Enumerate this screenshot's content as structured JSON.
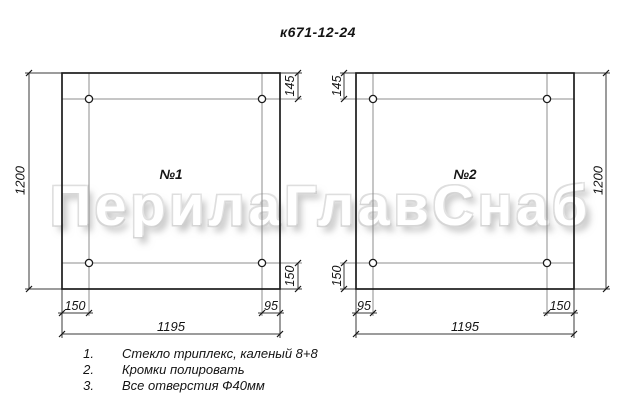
{
  "title": "к671-12-24",
  "watermark": "ПерилаГлавСнаб",
  "panel1": {
    "label": "№1",
    "dim_height": "1200",
    "dim_top_offset": "145",
    "dim_bottom_offset": "150",
    "dim_hole_left": "150",
    "dim_hole_right": "95",
    "dim_width": "1195"
  },
  "panel2": {
    "label": "№2",
    "dim_height": "1200",
    "dim_top_offset": "145",
    "dim_bottom_offset": "150",
    "dim_hole_left": "95",
    "dim_hole_right": "150",
    "dim_width": "1195"
  },
  "notes": [
    {
      "num": "1.",
      "text": "Стекло триплекс, каленый 8+8"
    },
    {
      "num": "2.",
      "text": "Кромки полировать"
    },
    {
      "num": "3.",
      "text": "Все отверстия Ф40мм"
    }
  ],
  "colors": {
    "outline": "#1c1c1c",
    "construction": "#8c8c8c",
    "dimension": "#3a3a3a",
    "watermark_outline": "#d6d6d6"
  }
}
